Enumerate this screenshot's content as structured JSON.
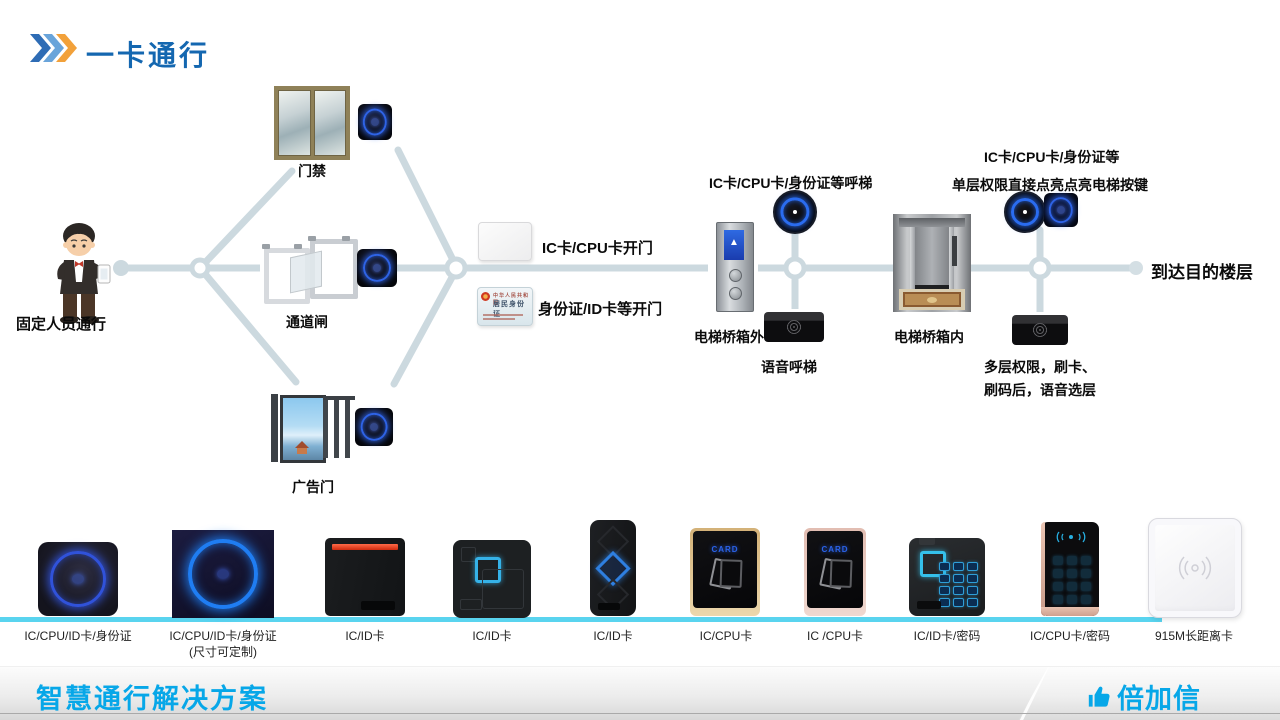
{
  "header": {
    "title": "一卡通行"
  },
  "flow": {
    "person_label": "固定人员通行",
    "gate1_label": "门禁",
    "gate2_label": "通道闸",
    "gate3_label": "广告门",
    "card_open": "IC卡/CPU卡开门",
    "id_open": "身份证/ID卡等开门",
    "id_card_country": "中华人民共和国",
    "id_card_title": "居民身份证",
    "call_label": "IC卡/CPU卡/身份证等呼梯",
    "outside_label": "电梯桥箱外",
    "voice_call": "语音呼梯",
    "inside_line1": "IC卡/CPU卡/身份证等",
    "inside_line2": "单层权限直接点亮点亮电梯按键",
    "inside_label": "电梯桥箱内",
    "multi_line1": "多层权限，刷卡、",
    "multi_line2": "刷码后，语音选层",
    "destination": "到达目的楼层",
    "panel_arrow": "▲"
  },
  "products": [
    {
      "label": "IC/CPU/ID卡/身份证",
      "sublabel": ""
    },
    {
      "label": "IC/CPU/ID卡/身份证",
      "sublabel": "(尺寸可定制)"
    },
    {
      "label": "IC/ID卡"
    },
    {
      "label": "IC/ID卡"
    },
    {
      "label": "IC/ID卡"
    },
    {
      "label": "IC/CPU卡",
      "screen_text": "CARD"
    },
    {
      "label": "IC /CPU卡",
      "screen_text": "CARD"
    },
    {
      "label": "IC/ID卡/密码"
    },
    {
      "label": "IC/CPU卡/密码"
    },
    {
      "label": "915M长距离卡"
    }
  ],
  "footer": {
    "title": "智慧通行解决方案",
    "brand": "倍加信"
  },
  "colors": {
    "title_blue": "#1467b0",
    "chevron1": "#2e6cb5",
    "chevron2": "#69a4da",
    "chevron3": "#f2a13a",
    "accent_cyan": "#07a7e8",
    "wire_gray": "#ccd9df",
    "shelf_cyan": "#59d4ef",
    "reader_ring_blue": "#2a6cf0"
  }
}
